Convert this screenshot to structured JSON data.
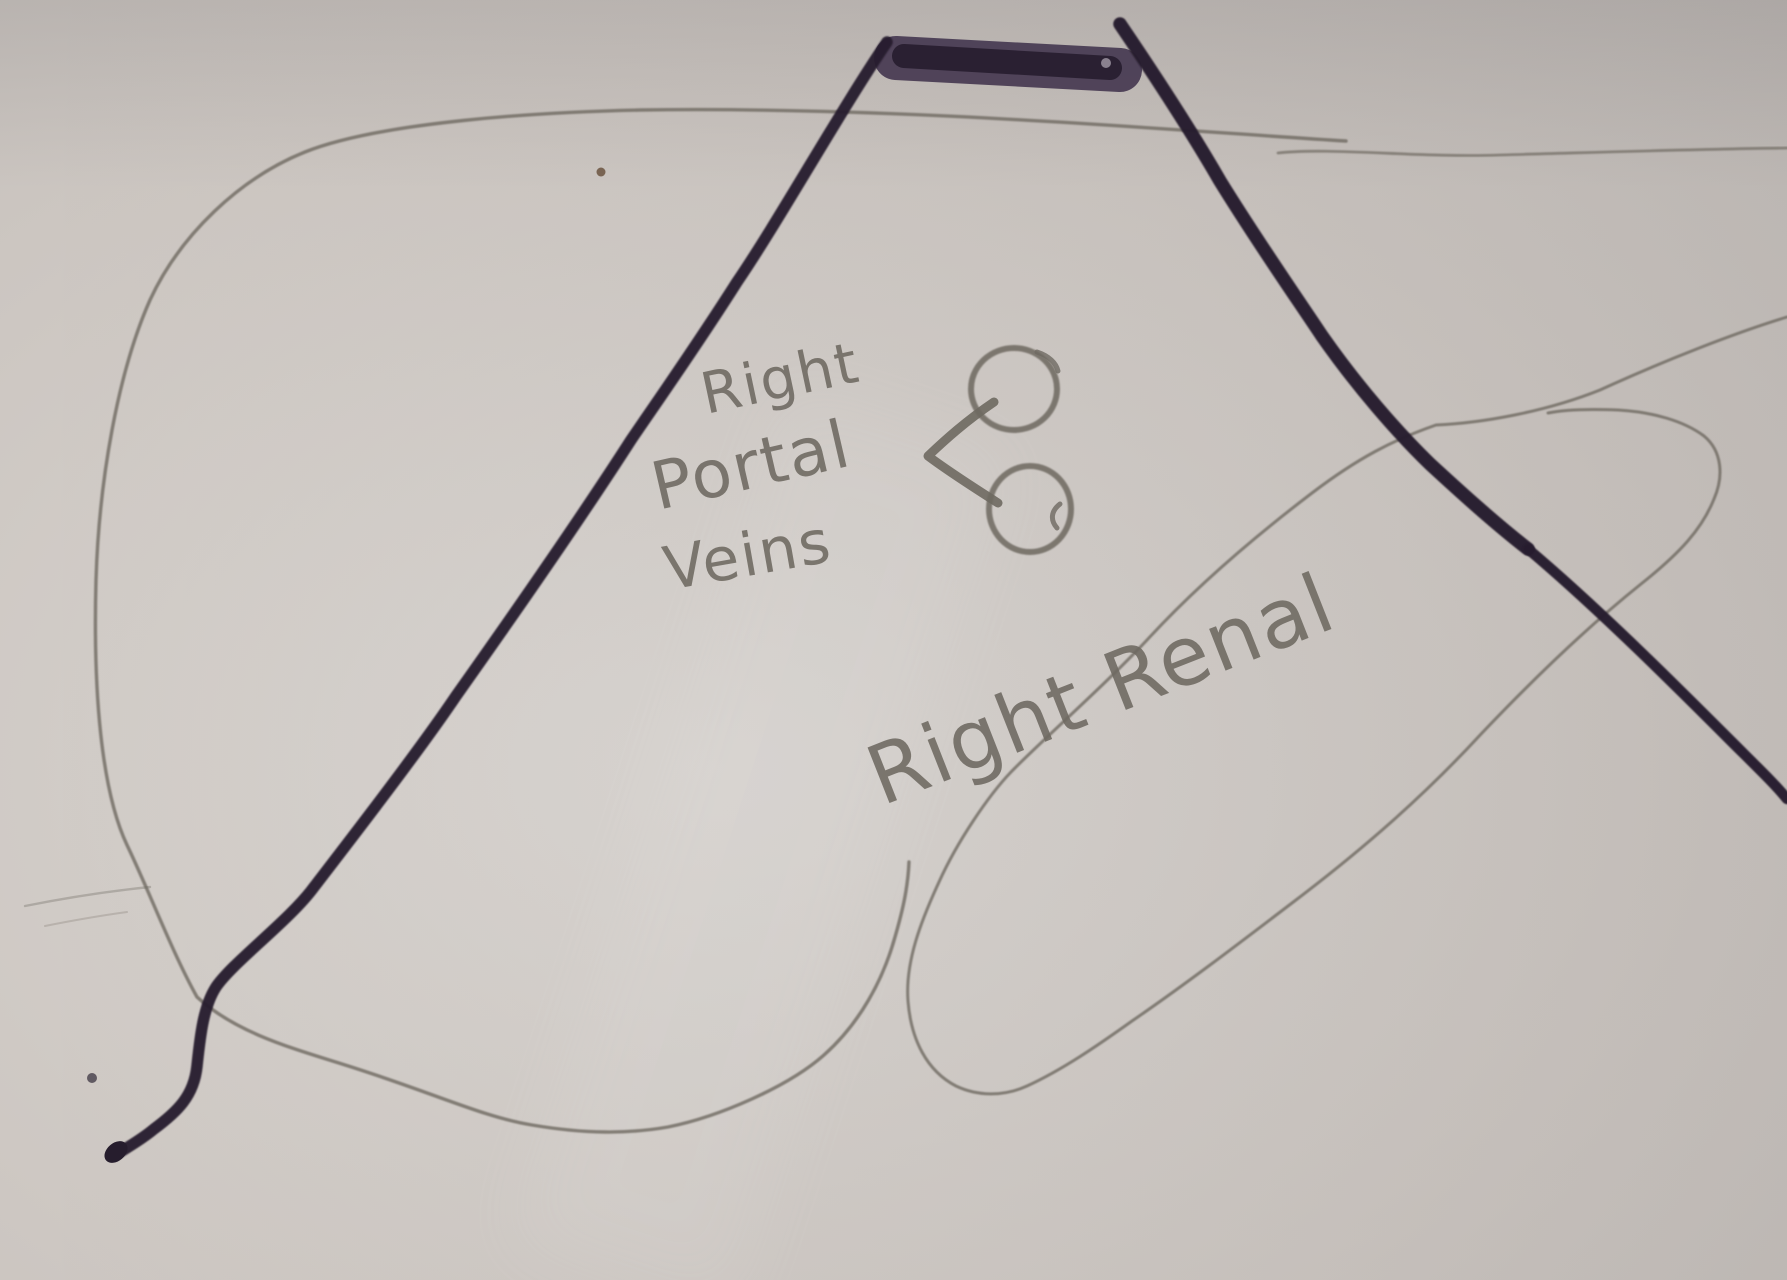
{
  "labels": {
    "portal_line1": "Right",
    "portal_line2": "Portal",
    "portal_line3": "Veins",
    "renal": "Right Renal"
  },
  "colors": {
    "paper": "#cdc7c2",
    "paper-light": "#dad6d2",
    "paper-dark": "#c0bbb7",
    "pencil": "#6e6961",
    "pencil-soft": "#938e86",
    "marker": "#261d2d",
    "marker-soft": "#473a52"
  }
}
